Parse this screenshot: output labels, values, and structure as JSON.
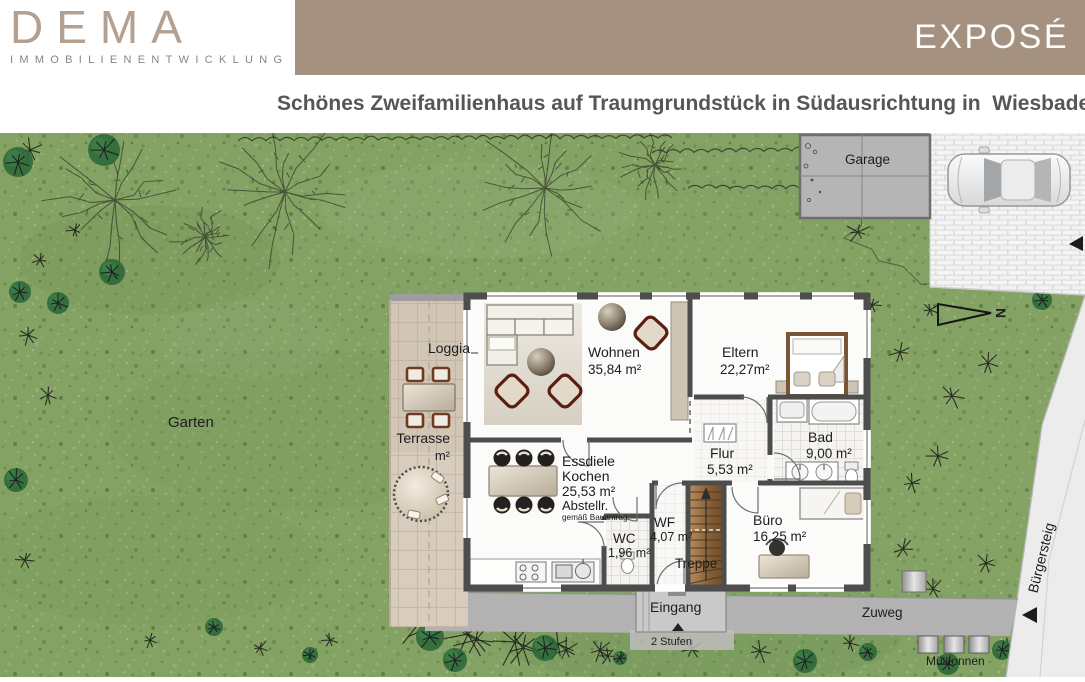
{
  "header": {
    "logo": {
      "name": "DEMA",
      "subtitle": "IMMOBILIENENTWICKLUNG"
    },
    "banner": {
      "label": "EXPOSÉ",
      "color": "#a4917f"
    },
    "title": "Schönes Zweifamilienhaus auf Traumgrundstück in Südausrichtung in  Wiesbaden"
  },
  "site_plan": {
    "outdoor": {
      "garage": "Garage",
      "garten": "Garten",
      "loggia": "Loggia",
      "terrasse": "Terrasse",
      "terrasse_area": "m²",
      "eingang": "Eingang",
      "stufen": "2 Stufen",
      "zuweg": "Zuweg",
      "muelltonnen": "Mülltonnen",
      "buergersteig": "Bürgersteig",
      "north": "N"
    },
    "rooms": [
      {
        "id": "wohnen",
        "name": "Wohnen",
        "area": "35,84 m²"
      },
      {
        "id": "eltern",
        "name": "Eltern",
        "area": "22,27m²"
      },
      {
        "id": "bad",
        "name": "Bad",
        "area": "9,00 m²"
      },
      {
        "id": "flur",
        "name": "Flur",
        "area": "5,53 m²"
      },
      {
        "id": "essdiele",
        "name": "Essdiele",
        "name2": "Kochen",
        "area": "25,53 m²",
        "extra": "Abstellr.",
        "note": "gemäß Bauantrag"
      },
      {
        "id": "wc",
        "name": "WC",
        "area": "1,96 m²"
      },
      {
        "id": "wf",
        "name": "WF",
        "area": "4,07 m²"
      },
      {
        "id": "treppe",
        "name": "Treppe"
      },
      {
        "id": "buero",
        "name": "Büro",
        "area": "16,25 m²"
      }
    ],
    "colors": {
      "banner": "#a4917f",
      "grass": "#83a263",
      "wall": "#4d4d4d",
      "terrace_tile": "#d7ccbe",
      "concrete": "#b2b2b2",
      "sidewalk": "#ececec"
    }
  }
}
